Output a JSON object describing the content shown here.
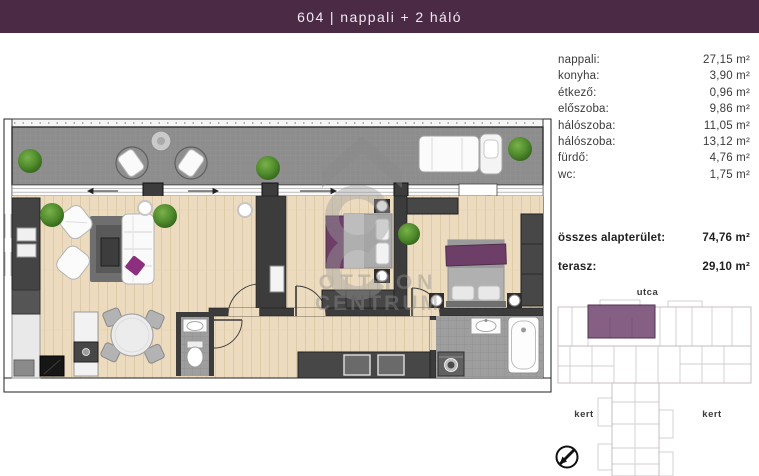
{
  "header": {
    "title": "604 | nappali + 2 háló"
  },
  "rooms": [
    {
      "label": "nappali:",
      "value": "27,15 m²"
    },
    {
      "label": "konyha:",
      "value": "3,90 m²"
    },
    {
      "label": "étkező:",
      "value": "0,96 m²"
    },
    {
      "label": "előszoba:",
      "value": "9,86 m²"
    },
    {
      "label": "hálószoba:",
      "value": "11,05 m²"
    },
    {
      "label": "hálószoba:",
      "value": "13,12 m²"
    },
    {
      "label": "fürdő:",
      "value": "4,76 m²"
    },
    {
      "label": "wc:",
      "value": "1,75 m²"
    }
  ],
  "totals": {
    "total_label": "összes alapterület:",
    "total_value": "74,76 m²",
    "terrace_label": "terasz:",
    "terrace_value": "29,10 m²"
  },
  "sitemap": {
    "street_label": "utca",
    "garden_left_label": "kert",
    "garden_right_label": "kert"
  },
  "watermark": {
    "line1": "OTTHON",
    "line2": "CENTRUM"
  },
  "colors": {
    "header_bg": "#4a2a45",
    "unit_highlight": "#7b527a",
    "furniture_purple": "#6d3f68",
    "accent_pillow": "#8c2f7e",
    "terrace_gray": "#8d8d8d",
    "wood_floor": "#ecdbbe"
  }
}
